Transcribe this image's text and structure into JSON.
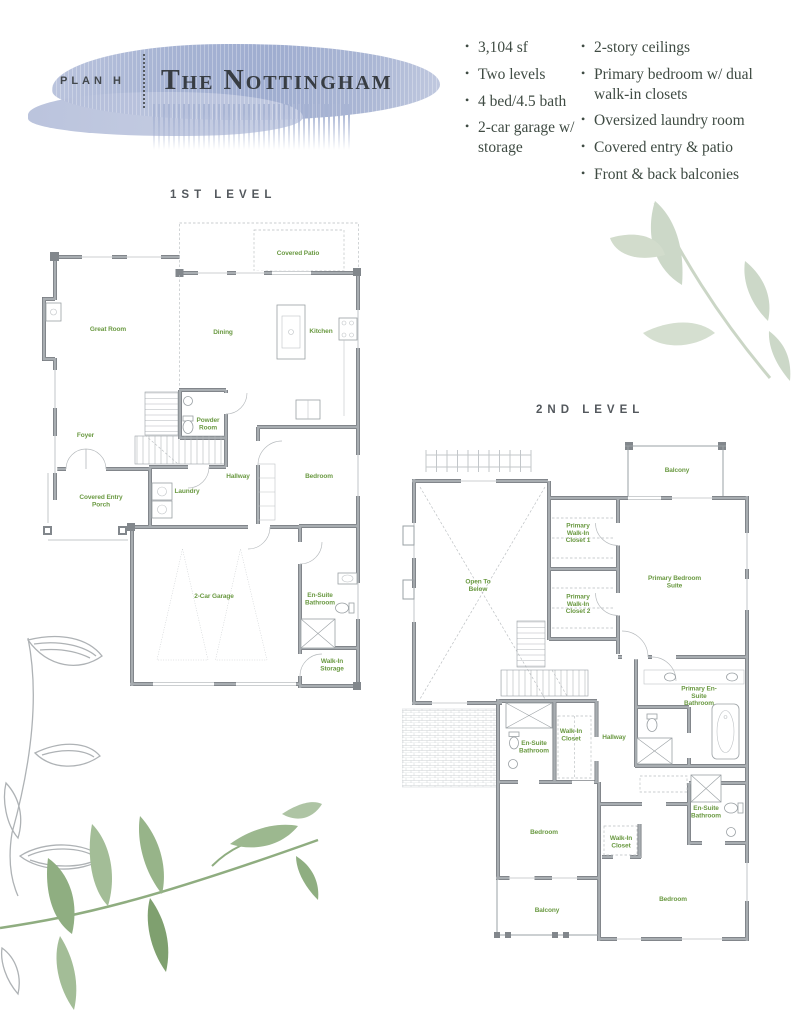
{
  "header": {
    "plan_label": "PLAN H",
    "title": "The Nottingham"
  },
  "features": {
    "column1": [
      "3,104 sf",
      "Two levels",
      "4 bed/4.5 bath",
      "2-car garage w/ storage"
    ],
    "column2": [
      "2-story ceilings",
      "Primary bedroom w/ dual walk-in closets",
      "Oversized laundry room",
      "Covered entry & patio",
      "Front & back balconies"
    ]
  },
  "level1": {
    "heading": "1ST LEVEL",
    "rooms": [
      "Covered Patio",
      "Great Room",
      "Dining",
      "Kitchen",
      "Foyer",
      "Powder Room",
      "Hallway",
      "Bedroom",
      "Laundry",
      "Covered Entry Porch",
      "2-Car Garage",
      "En-Suite Bathroom",
      "Walk-In Storage"
    ]
  },
  "level2": {
    "heading": "2ND LEVEL",
    "rooms": [
      "Balcony",
      "Open To Below",
      "Primary Walk-In Closet 1",
      "Primary Walk-In Closet 2",
      "Primary Bedroom Suite",
      "Primary En-Suite Bathroom",
      "Hallway",
      "Walk-In Closet",
      "En-Suite Bathroom",
      "Bedroom",
      "Walk-In Closet",
      "En-Suite Bathroom",
      "Balcony",
      "Bedroom"
    ]
  },
  "colors": {
    "watercolor_blue": "#a6b3d3",
    "room_label_green": "#6b9a43",
    "wall_gray": "#9aa0a4",
    "wall_outline_gray": "#75797e",
    "body_text_green_gray": "#3f4b43",
    "title_charcoal": "#383d43",
    "leaf_sage_pale": "#ccd7c7",
    "leaf_green": "#96b489"
  }
}
